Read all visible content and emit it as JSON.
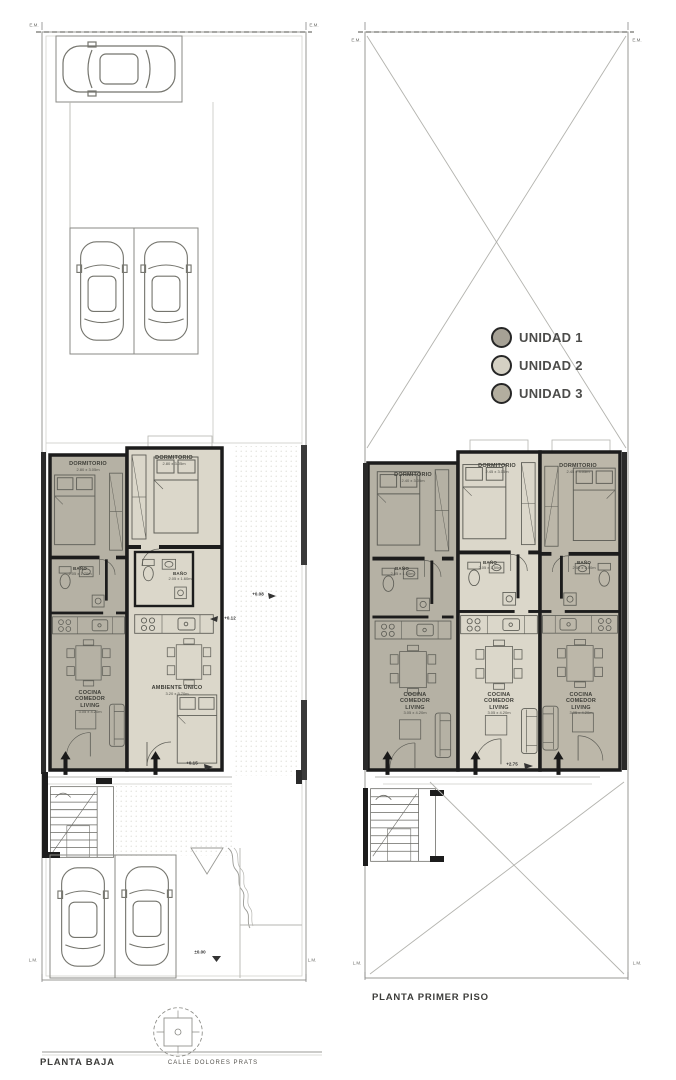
{
  "legend": {
    "items": [
      {
        "label": "UNIDAD 1",
        "color": "#a6a195"
      },
      {
        "label": "UNIDAD 2",
        "color": "#d5d1c4"
      },
      {
        "label": "UNIDAD 3",
        "color": "#b3ae9f"
      }
    ]
  },
  "ground_floor": {
    "title": "PLANTA BAJA",
    "street_name": "CALLE DOLORES PRATS",
    "markers": {
      "em": "E.M.",
      "lm": "L.M."
    },
    "levels": {
      "street": "±0.00",
      "entry": "+0.15",
      "patio": "+0.08",
      "step": "+0.12"
    },
    "unit1": {
      "bedroom_label": "DORMITORIO",
      "bedroom_dim": "2.80 x 3.05m",
      "bath_label": "BAÑO",
      "bath_dim": "2.05 x 1.70m",
      "living_label": "COCINA\nCOMEDOR\nLIVING",
      "living_dim": "3.05 x 4.20m"
    },
    "unit2": {
      "bedroom_label": "DORMITORIO",
      "bedroom_dim": "2.80 x 3.05m",
      "bath_label": "BAÑO",
      "bath_dim": "2.05 x 1.60m",
      "living_label": "AMBIENTE ÚNICO",
      "living_dim": "3.20 x 5.70m"
    }
  },
  "first_floor": {
    "title": "PLANTA PRIMER PISO",
    "markers": {
      "em": "E.M.",
      "lm": "L.M."
    },
    "levels": {
      "entry": "+2.75"
    },
    "unit1": {
      "bedroom_label": "DORMITORIO",
      "bedroom_dim": "2.40 x 3.05m",
      "bath_label": "BAÑO",
      "bath_dim": "2.05 x 1.50m",
      "living_label": "COCINA\nCOMEDOR\nLIVING",
      "living_dim": "3.05 x 4.20m"
    },
    "unit2": {
      "bedroom_label": "DORMITORIO",
      "bedroom_dim": "2.45 x 3.05m",
      "bath_label": "BAÑO",
      "bath_dim": "2.05 x 1.50m",
      "living_label": "COCINA\nCOMEDOR\nLIVING",
      "living_dim": "3.05 x 4.20m"
    },
    "unit3": {
      "bedroom_label": "DORMITORIO",
      "bedroom_dim": "2.45 x 3.05m",
      "bath_label": "BAÑO",
      "bath_dim": "2.05 x 1.50m",
      "living_label": "COCINA\nCOMEDOR\nLIVING",
      "living_dim": "3.05 x 4.20m"
    }
  }
}
